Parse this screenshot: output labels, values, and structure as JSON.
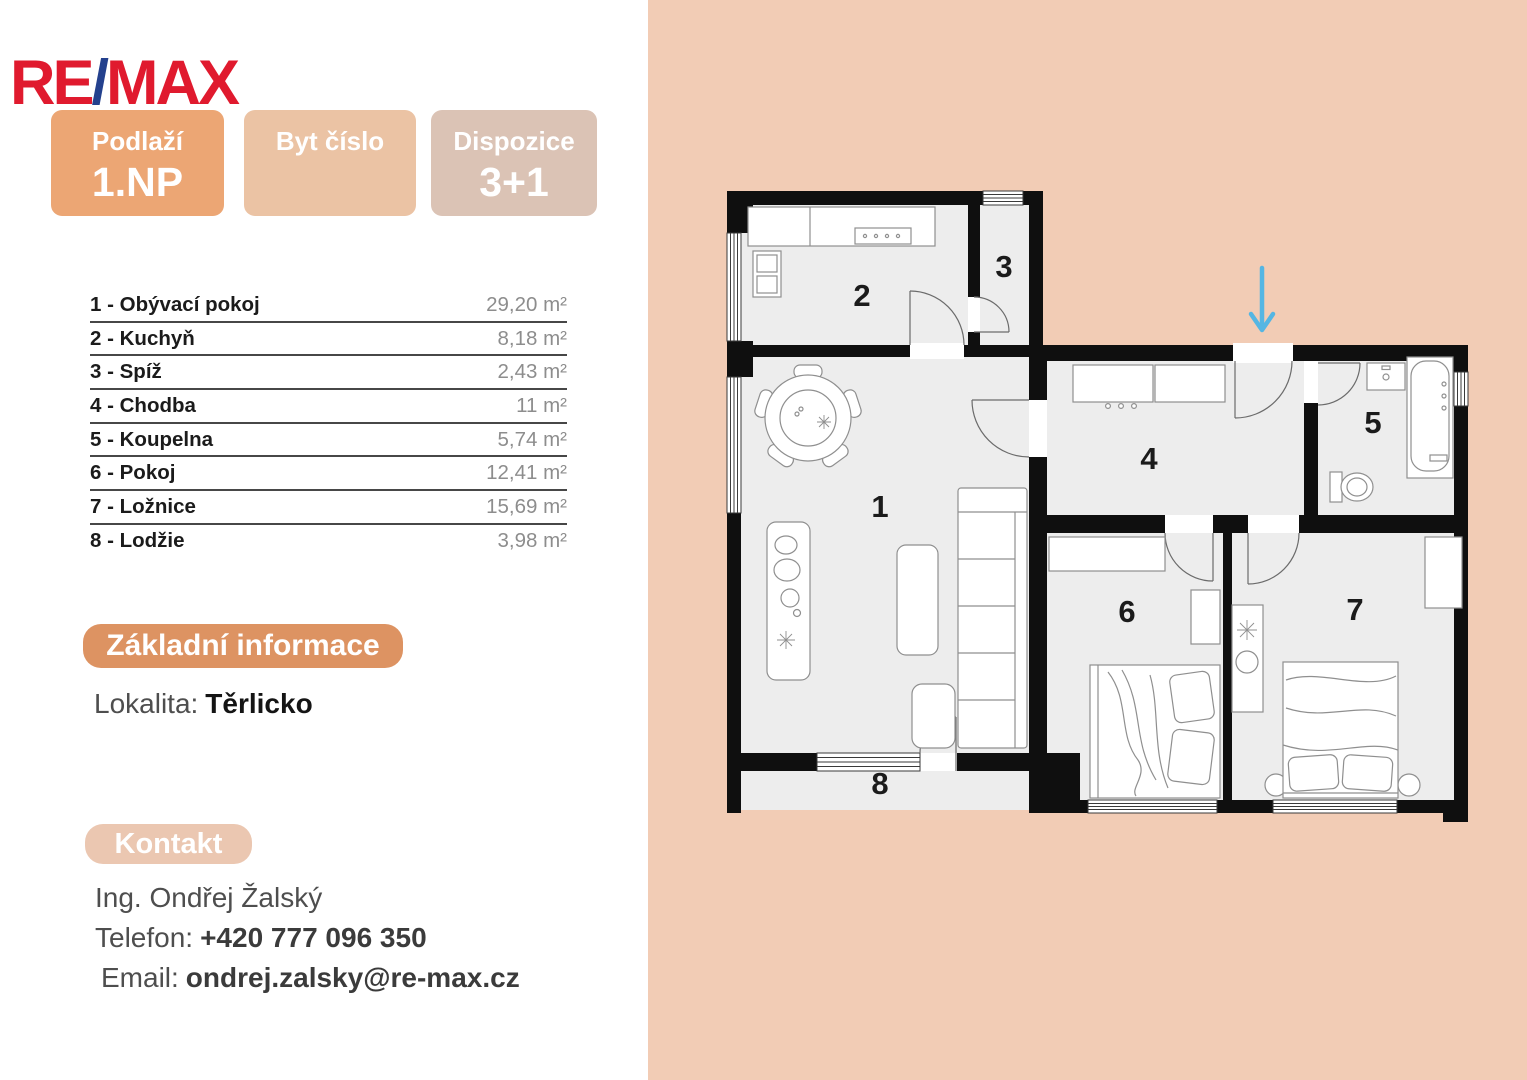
{
  "brand": {
    "re": "RE",
    "slash": "/",
    "max": "MAX",
    "red": "#e01a2e",
    "blue": "#24418e"
  },
  "badges": [
    {
      "label": "Podlaží",
      "value": "1.NP",
      "bg": "#eca674"
    },
    {
      "label": "Byt číslo",
      "value": "",
      "bg": "#ebc3a4"
    },
    {
      "label": "Dispozice",
      "value": "3+1",
      "bg": "#dbc3b5"
    }
  ],
  "room_table": {
    "rows": [
      {
        "label": "1 - Obývací pokoj",
        "area": "29,20 m²"
      },
      {
        "label": "2 - Kuchyň",
        "area": "8,18 m²"
      },
      {
        "label": "3 - Spíž",
        "area": "2,43 m²"
      },
      {
        "label": "4 - Chodba",
        "area": "11 m²"
      },
      {
        "label": "5 - Koupelna",
        "area": "5,74 m²"
      },
      {
        "label": "6 - Pokoj",
        "area": "12,41 m²"
      },
      {
        "label": "7 - Ložnice",
        "area": "15,69 m²"
      },
      {
        "label": "8 - Lodžie",
        "area": "3,98 m²"
      }
    ]
  },
  "info": {
    "title": "Základní informace",
    "lokalita_label": "Lokalita:",
    "lokalita_value": "Těrlicko"
  },
  "contact": {
    "title": "Kontakt",
    "name": "Ing. Ondřej Žalský",
    "phone_label": "Telefon:",
    "phone": "+420 777 096 350",
    "email_label": "Email:",
    "email": "ondrej.zalsky@re-max.cz"
  },
  "floorplan": {
    "labels": [
      "1",
      "2",
      "3",
      "4",
      "5",
      "6",
      "7",
      "8"
    ],
    "colors": {
      "background": "#f2ccb5",
      "floor": "#ededed",
      "wall": "#0f0f0f",
      "arrow": "#55b6e3"
    }
  }
}
